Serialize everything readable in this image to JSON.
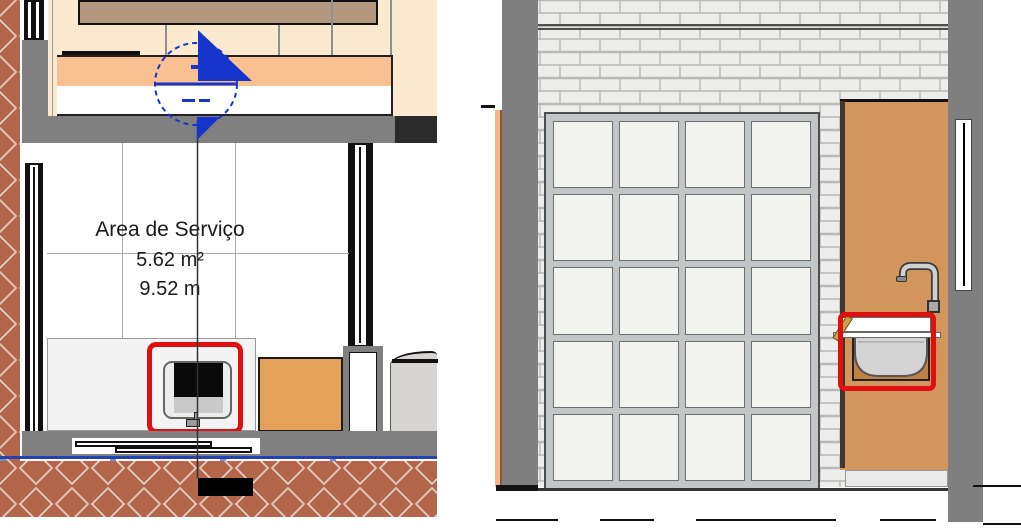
{
  "floor_plan": {
    "room": {
      "name": "Area de Serviço",
      "area": "5.62 m²",
      "perimeter": "9.52 m"
    }
  },
  "colors": {
    "selection_red": "#e01010",
    "section_marker_blue": "#1535cc",
    "wall_gray": "#808080",
    "exterior_paving_terracotta": "#b4664b",
    "cabinet_wood_tan": "#d2955b",
    "countertop_peach": "#f9c091",
    "kitchen_floor_cream": "#fbe9d0",
    "boundary_blue": "#2543b0"
  }
}
